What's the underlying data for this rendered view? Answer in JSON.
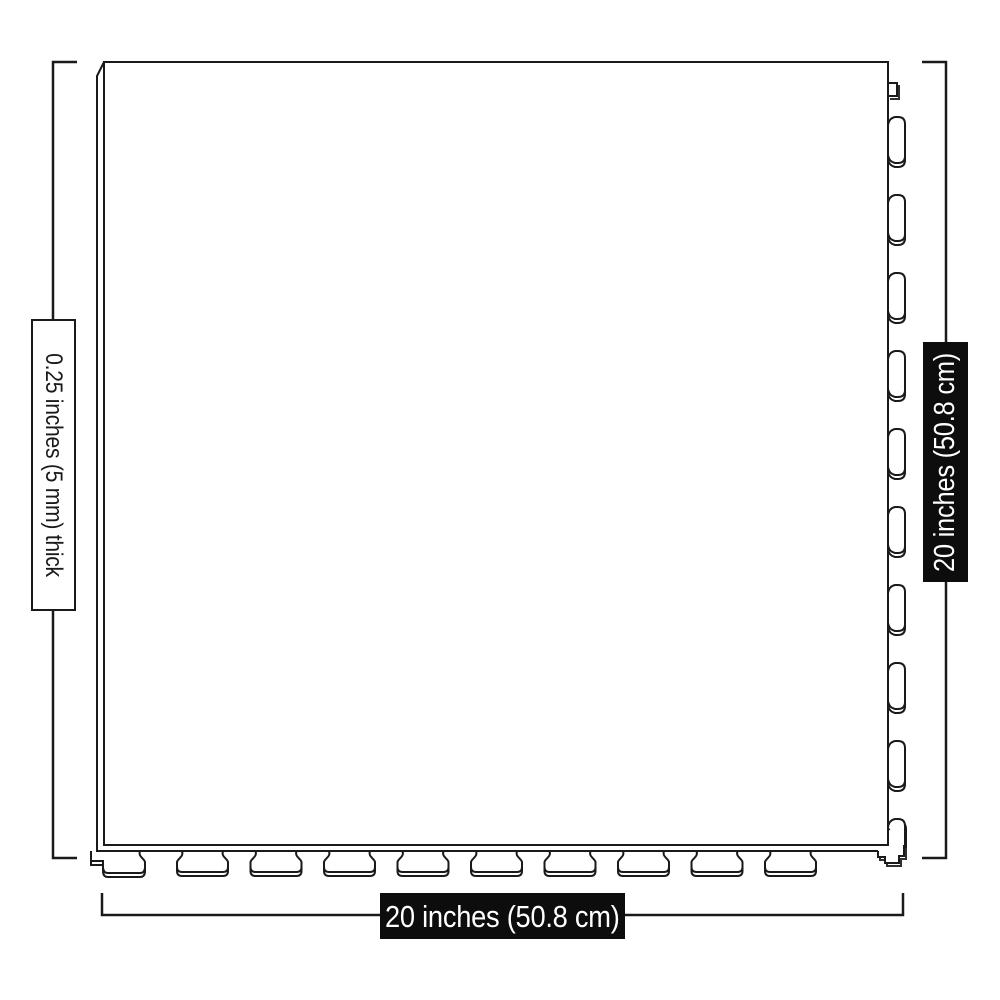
{
  "diagram": {
    "kind": "tile-dimension-diagram",
    "labels": {
      "thickness": "0.25 inches (5 mm) thick",
      "side": "20 inches (50.8 cm)",
      "bottom": "20 inches (50.8 cm)"
    },
    "colors": {
      "line": "#1a1a1a",
      "dark_label_bg": "#0d0d0d",
      "dark_label_text": "#ffffff",
      "light_label_bg": "#ffffff",
      "light_label_text": "#1a1a1a"
    }
  }
}
